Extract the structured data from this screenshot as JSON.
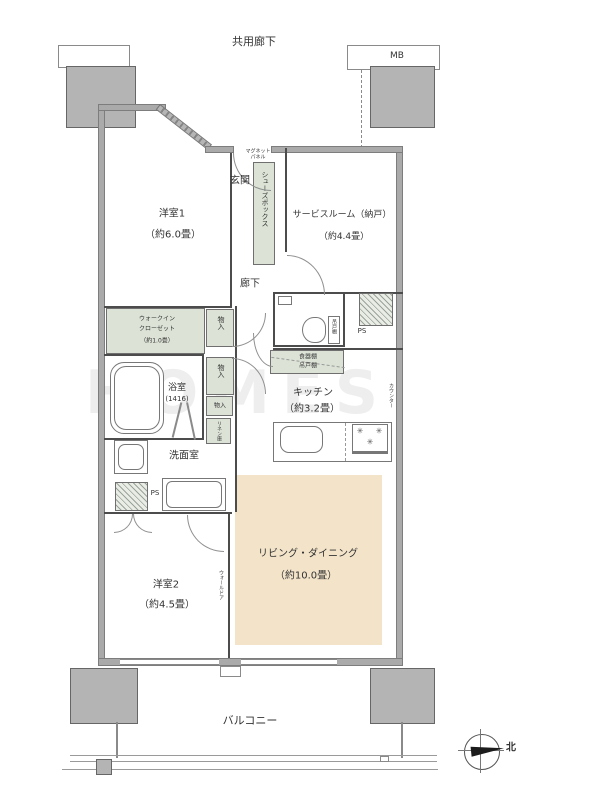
{
  "colors": {
    "living_fill": "#f2e3c9",
    "storage_fill": "#dce3d6",
    "wall_gray": "#aaaaaa"
  },
  "outside": {
    "common_corridor": "共用廊下",
    "mb_label": "MB",
    "balcony_label": "バルコニー",
    "north_label": "北",
    "watermark": "HOMES"
  },
  "rooms": {
    "western1_name": "洋室1",
    "western1_size": "（約6.0畳）",
    "western2_name": "洋室2",
    "western2_size": "（約4.5畳）",
    "service_name": "サービスルーム（納戸）",
    "service_size": "（約4.4畳）",
    "living_name": "リビング・ダイニング",
    "living_size": "（約10.0畳）",
    "kitchen_name": "キッチン",
    "kitchen_size": "（約3.2畳）",
    "entrance": "玄関",
    "hallway": "廊下",
    "washroom": "洗面室",
    "bath_name": "浴室",
    "bath_size": "(1416)",
    "wic_line1": "ウォークイン",
    "wic_line2": "クローゼット",
    "wic_size": "（約1.0畳）"
  },
  "fixtures": {
    "shoe_box": "シューズボックス",
    "closet_a": "物入",
    "closet_b": "物入",
    "closet_c": "物入",
    "linen": "リネン庫",
    "cupboard_line1": "食器棚",
    "cupboard_line2": "吊戸棚",
    "toilet_shelf": "吊戸棚",
    "counter": "カウンター",
    "wall_door": "ウォールドア",
    "entrance_panel_line1": "マグネット",
    "entrance_panel_line2": "パネル",
    "ps_a": "PS",
    "ps_b": "PS"
  }
}
